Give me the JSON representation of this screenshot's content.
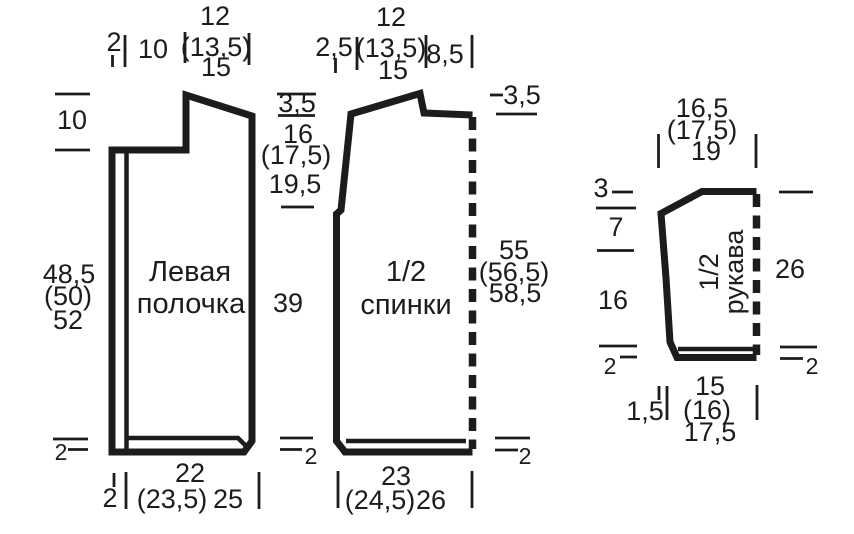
{
  "colors": {
    "ink": "#1c1c1c",
    "background": "#ffffff"
  },
  "front": {
    "label_line1": "Левая",
    "label_line2": "полочка",
    "top_band": "2",
    "top_neck": "10",
    "shoulder_1": "12",
    "shoulder_2": "(13,5)",
    "shoulder_3": "15",
    "neck_drop": "10",
    "len_1": "48,5",
    "len_2": "(50)",
    "len_3": "52",
    "hem": "2",
    "bottom_band": "2",
    "width_1": "22",
    "width_2": "(23,5)",
    "width_3": "25"
  },
  "armhole_col": {
    "slope": "3,5",
    "depth_1": "16",
    "depth_2": "(17,5)",
    "depth_3": "19,5",
    "side": "39",
    "hem": "2"
  },
  "back": {
    "label_line1": "1/2",
    "label_line2": "спинки",
    "top_offset": "2,5",
    "shoulder_1": "12",
    "shoulder_2": "(13,5)",
    "shoulder_3": "15",
    "neck": "8,5",
    "neck_drop": "3,5",
    "len_1": "55",
    "len_2": "(56,5)",
    "len_3": "58,5",
    "hem": "2",
    "width_1": "23",
    "width_2": "(24,5)",
    "width_3": "26"
  },
  "sleeve": {
    "label_line1": "1/2",
    "label_line2": "рукава",
    "top_1": "16,5",
    "top_2": "(17,5)",
    "top_3": "19",
    "cap_height": "3",
    "cap_slope": "7",
    "left_len": "16",
    "right_len": "26",
    "hem_left": "2",
    "hem_right": "2",
    "cuff_offset": "1,5",
    "width_1": "15",
    "width_2": "(16)",
    "width_3": "17,5"
  }
}
